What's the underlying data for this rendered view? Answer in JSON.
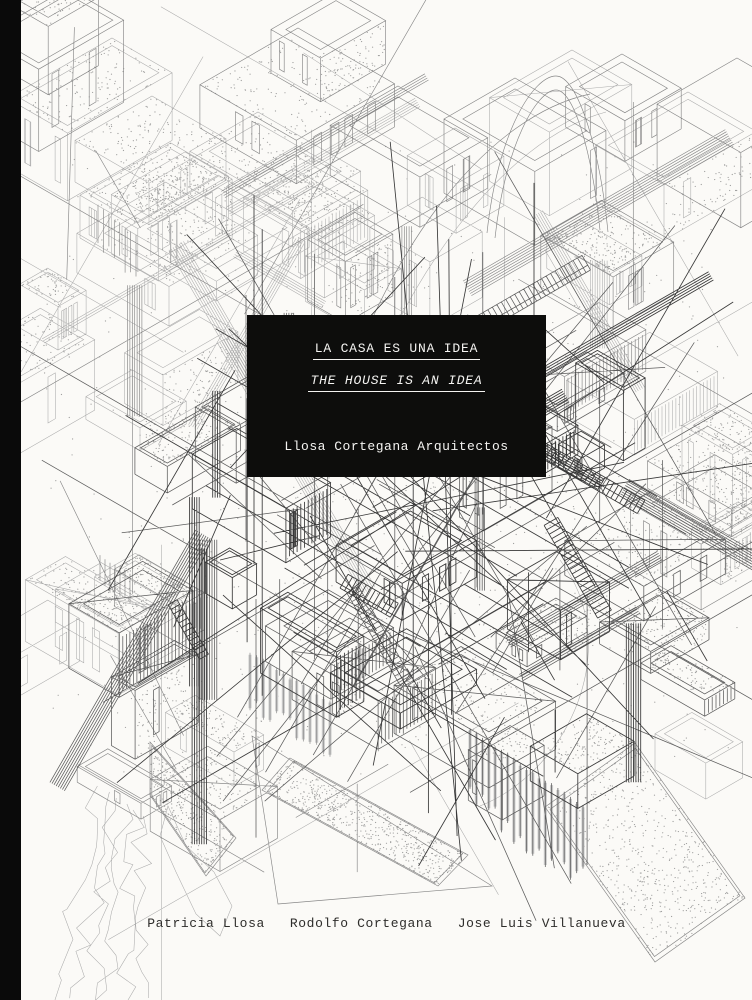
{
  "cover": {
    "type": "book-cover",
    "title_box": {
      "title_es": "LA CASA ES UNA IDEA",
      "title_en": "THE HOUSE IS AN IDEA",
      "studio": "Llosa Cortegana Arquitectos"
    },
    "authors": [
      "Patricia Llosa",
      "Rodolfo Cortegana",
      "Jose Luis Villanueva"
    ],
    "colors": {
      "paper": "#fbfaf7",
      "spine": "#0a0a0a",
      "title_box_bg": "#0d0d0c",
      "title_box_text": "#f4f3f1",
      "author_text": "#2e2d2b",
      "drawing_ink": "#6e6e6e"
    },
    "artwork": {
      "name": "overlapping-axonometric-houses-wireframe-drawing"
    }
  }
}
